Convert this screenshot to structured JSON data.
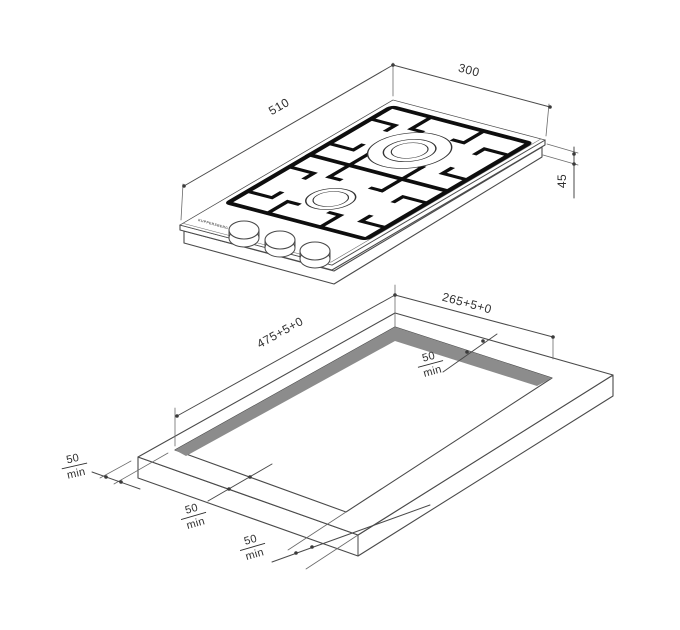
{
  "drawing": {
    "type": "gas-hob-installation-diagram",
    "brand_text": "KUPPERSBERG",
    "hob_view": {
      "width_label": "510",
      "depth_label": "300",
      "height_label": "45",
      "burners": [
        "large",
        "small"
      ],
      "knob_count": 3
    },
    "cutout_view": {
      "length_label": "475+5+0",
      "width_label": "265+5+0"
    },
    "clearance": {
      "value": "50",
      "unit": "min",
      "instances": [
        "left",
        "front-left",
        "front-right",
        "top-right"
      ]
    },
    "colors": {
      "line": "#4a4a4a",
      "grate": "#0e0e0e",
      "cutout_wall": "#8c8c8c",
      "background": "#ffffff"
    }
  }
}
